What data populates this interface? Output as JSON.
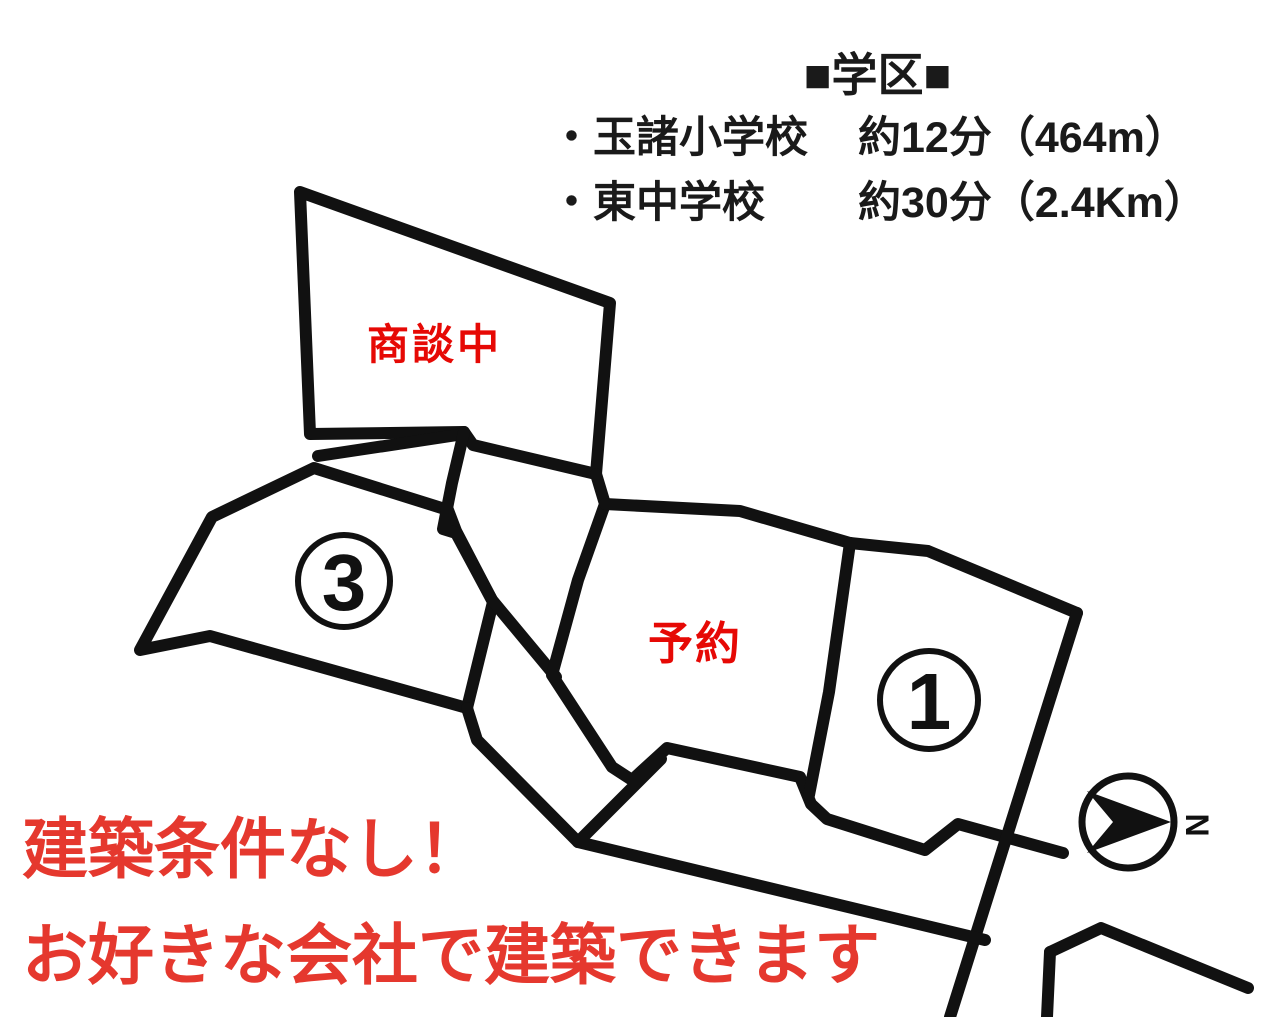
{
  "school_district": {
    "title": "■学区■",
    "items": [
      {
        "name": "・玉諸小学校",
        "time_distance": "約12分（464m）"
      },
      {
        "name": "・東中学校",
        "time_distance": "約30分（2.4Km）"
      }
    ]
  },
  "plots": {
    "negotiating": {
      "label": "商談中",
      "status_meaning": "under negotiation"
    },
    "reserved": {
      "label": "予約",
      "status_meaning": "reserved"
    },
    "plot1": {
      "number": "1"
    },
    "plot3": {
      "number": "3"
    }
  },
  "compass": {
    "north": "N"
  },
  "banner": {
    "line1": "建築条件なし！",
    "line2": "お好きな会社で建築できます"
  },
  "colors": {
    "line_black": "#111111",
    "label_red": "#e60905",
    "banner_red": "#e5382e",
    "text_black": "#1a1a1a"
  }
}
